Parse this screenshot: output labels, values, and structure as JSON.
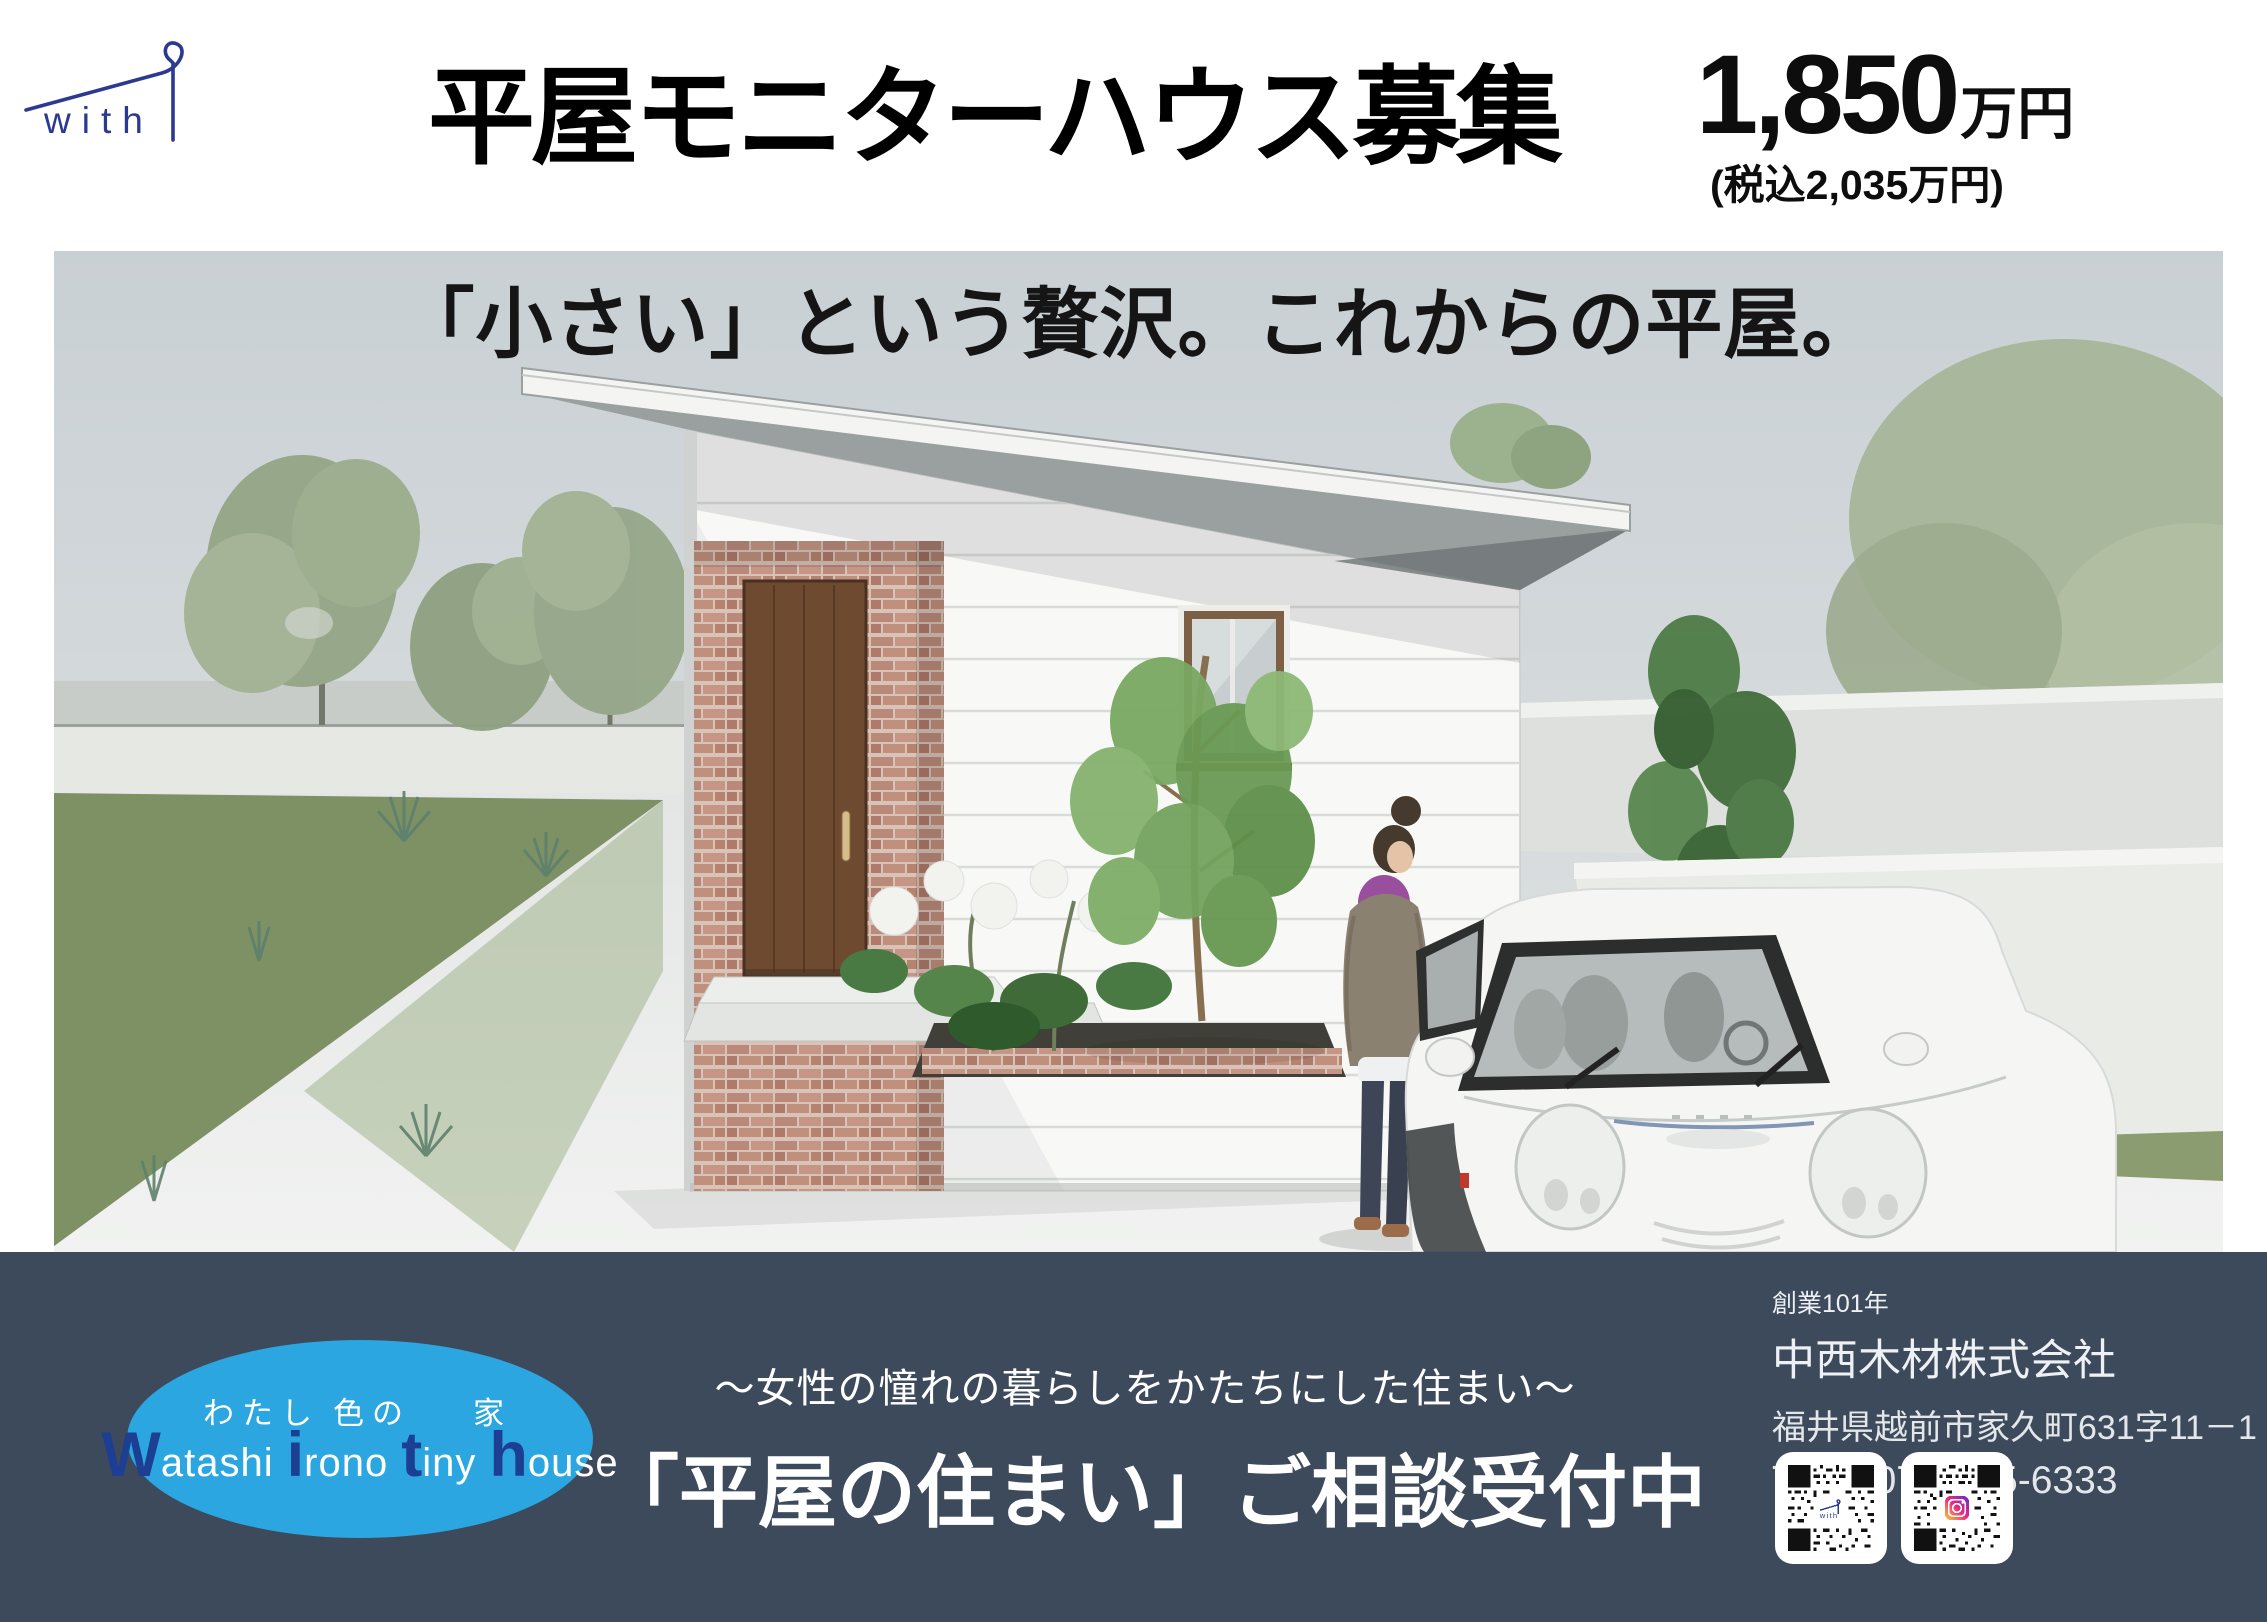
{
  "header": {
    "logo": {
      "text": "with",
      "color": "#2b3990"
    },
    "title": "平屋モニターハウス募集",
    "price": {
      "amount": "1,850",
      "unit": "万円",
      "tax_note": "(税込2,035万円)"
    }
  },
  "hero": {
    "caption": "「小さい」という贅沢。これからの平屋。"
  },
  "footer": {
    "bar_color": "#3d4a5c",
    "badge": {
      "ellipse_color": "#2ca6e0",
      "accent_color": "#1d3f93",
      "jp_words": [
        "わたし",
        "色の",
        "家"
      ],
      "romaji": [
        {
          "big": "W",
          "rest": "atashi"
        },
        {
          "big": "i",
          "rest": "rono"
        },
        {
          "big": "t",
          "rest": "iny"
        },
        {
          "big": "h",
          "rest": "ouse"
        }
      ]
    },
    "tagline": "〜女性の憧れの暮らしをかたちにした住まい〜",
    "cta": "「平屋の住まい」ご相談受付中",
    "company": {
      "since": "創業101年",
      "name": "中西木材株式会社",
      "address": "福井県越前市家久町631字11－1",
      "tel": "TEL : 0778-25-6333"
    },
    "qr_codes": [
      {
        "label": "with-site-qr",
        "center_logo": "with"
      },
      {
        "label": "instagram-qr",
        "center_logo": "instagram"
      }
    ]
  }
}
